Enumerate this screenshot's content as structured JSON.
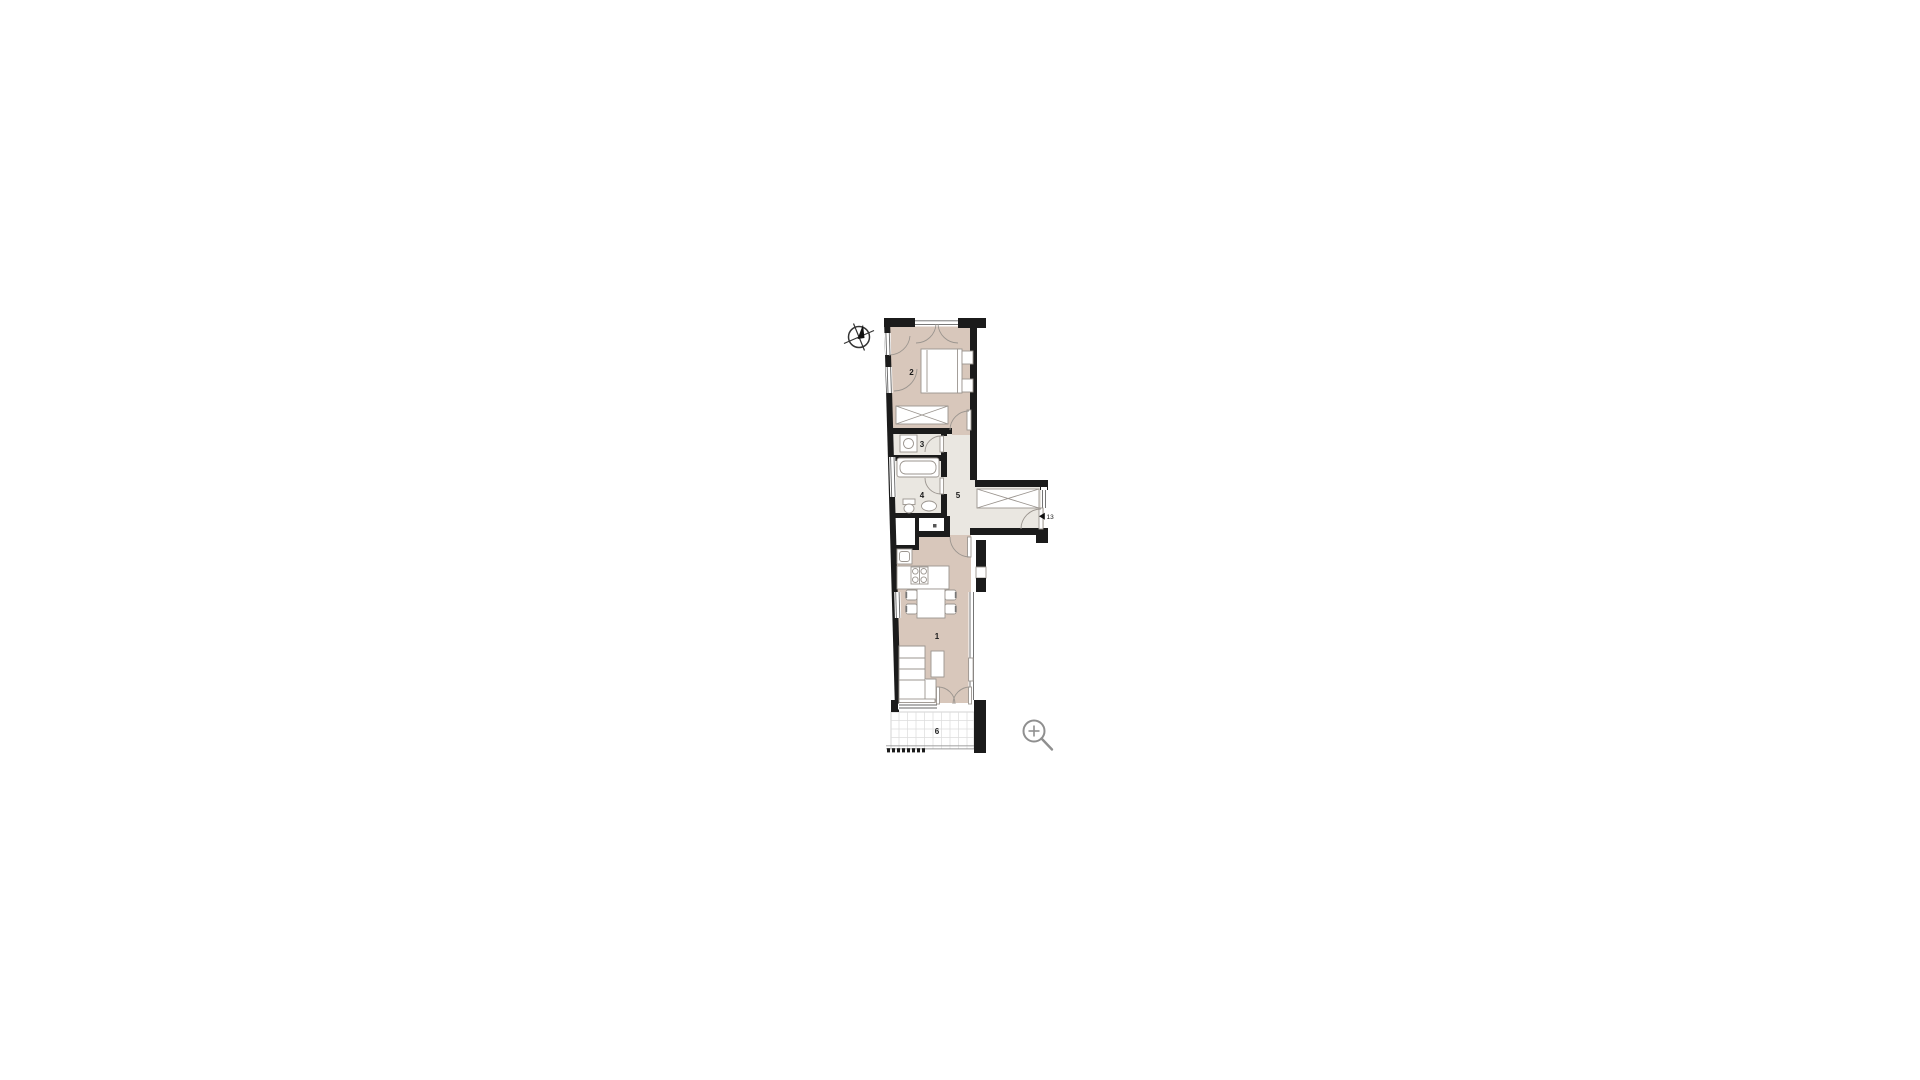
{
  "page": {
    "background_color": "#ffffff"
  },
  "floorplan": {
    "labels": {
      "room1": "1",
      "room2": "2",
      "room3": "3",
      "room4": "4",
      "room5": "5",
      "room6": "6",
      "entry_door": "13"
    },
    "colors": {
      "wall": "#1b1b1b",
      "floor_beige": "#d8c7bb",
      "floor_gray": "#eae7e1",
      "floor_white": "#ffffff",
      "furniture_stroke": "#9b958f",
      "window_stroke": "#666666",
      "terrace_grid": "#dcdcdc",
      "icon_gray": "#8f8f8f",
      "label_color": "#1a1a1a"
    },
    "icons": [
      {
        "name": "compass-icon"
      },
      {
        "name": "zoom-in-icon"
      }
    ]
  }
}
